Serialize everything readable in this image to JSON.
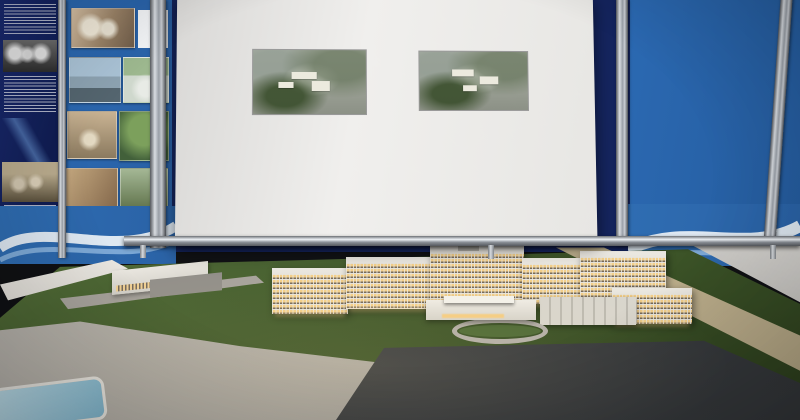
{
  "meta": {
    "scene_description": "Exhibition photo: project passport board of a 630-bed multidisciplinary regional hospital above an illuminated architectural scale model"
  },
  "poster": {
    "title": "ПАСПОРТ ПРОЕКТА",
    "left_lines": [
      {
        "b": "Заказчик:",
        "t": " ТОО «РасЭль Компани»"
      },
      {
        "b": "Генеральный проектировщик:"
      },
      {
        "t": "ТОО «Синтез Проект KZ»"
      },
      {
        "b": "Генподрядчик:"
      },
      {
        "t": "ТОО \"Romania Infra Construction\" (Ромениа Инфра Констракшн)"
      },
      {
        "b": "Месторасположение:"
      },
      {
        "t": "Акмолинская обл., г. Кокшетау, микрорайон Сарыарка"
      }
    ],
    "right_lines": [
      {
        "b": "Наименование проекта:"
      },
      {
        "t": "Многопрофильная областная больница на 630 коек"
      }
    ],
    "render_left_caption": "Вид с главного входа",
    "render_right_caption": "Вид с заднего двора",
    "indicators_heading": "Технико-экономические показатели и количественные характеристики зданий и сооружений",
    "capacity_lines": [
      "Конечная мощность стационара – 630 коек",
      "Клинико-диагностический центр на 500 посещений",
      "Этажность:",
      "- Основное здание больницы: 8 этажей, подвал и технический этаж;",
      "- Техническое здание с административно-хозяйственными отделениями, парковкой в цоколе и прачечной: 2 этажа;",
      "- Здание с отделением по управлению отходами: 1 этаж;",
      "- Здание дезинфекции транспорта: 1 этаж;",
      "- КПП: 1 этаж."
    ],
    "schedule_lines": [
      "Продолжительность строительства (сокращенная):",
      "24 месяца, в т.ч. подготовительный период 4 месяца",
      "Начало строительства: III квартал 2023 года",
      "Окончание строительства: III квартал 2025 года",
      "Общая площадь земельного участка: 17,0972 га",
      "Общая площадь зданий и сооружений: 119 767 м²",
      "Строительный объем:",
      "- В т.ч. выше отм. 0,000: 478 469",
      "- В т.ч. ниже отм. 0,000: 122 253"
    ],
    "additional_heading": "Дополнительные сведения (в том числе):",
    "additional_lines": [
      "В комплекс зданий больницы входят: основное здание больницы, техническое здание с административно-хозяйственными отделениями, парковкой в цоколе, здание с отделением по управлению отходами, здание дезинфекции транспорта и КПП.",
      "Хирургический блок позволяет оказывать стационарную и амбулаторную помощь в 25 операционных.",
      "В больнице предусматривается размещение следующего тяжелого медицинского оборудования:",
      "- линейного ускорителя;",
      "- компьютерных томографов (128 срезов);",
      "- магнитно-резонансных томографов (3 Тесла);",
      "- ангиографа;",
      "- цифровых рентген установок;",
      "Многопрофильная больница будет иметь автономный энергетический наружный источник. Всего предполагается создание около 2000 рабочих мест."
    ]
  },
  "left_board": {
    "caption_lines": [
      "Итоговый",
      "Больничный",
      "Совет",
      "(2007)"
    ]
  },
  "model": {
    "colors": {
      "board_blue": "#2b69b2",
      "banner_navy": "#16246b",
      "window_lit": "#f3cf8a",
      "light_glow": "#ffe9ad",
      "tree_dark": "#2e4520",
      "tree_light": "#6f8c42",
      "road": "#b7b3ac",
      "parking": "#3a3d40",
      "pond": "#a6cede",
      "floor": "#c9c7c3"
    },
    "tree_count": 150,
    "ground_light_count": 58,
    "street_light_count": 26,
    "parked_car_count": 30,
    "road_car_count": 9
  }
}
